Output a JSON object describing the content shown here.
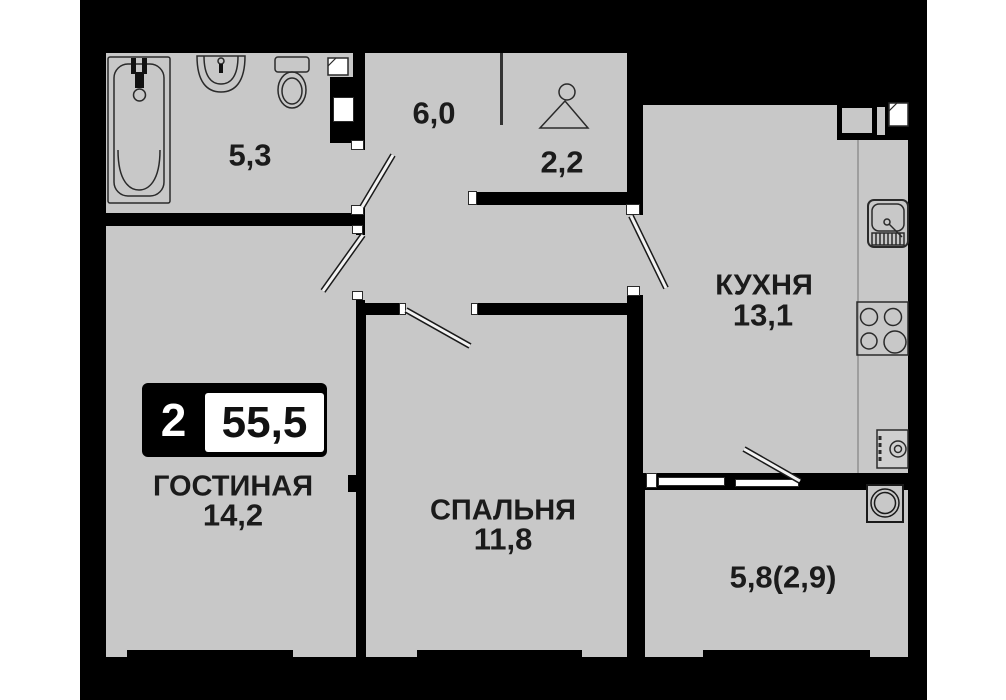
{
  "badge": {
    "rooms_count": "2",
    "total_area": "55,5"
  },
  "rooms": {
    "bathroom": {
      "area": "5,3"
    },
    "hallway": {
      "area": "6,0"
    },
    "wardrobe": {
      "area": "2,2"
    },
    "kitchen": {
      "name": "КУХНЯ",
      "area": "13,1"
    },
    "living_room": {
      "name": "ГОСТИНАЯ",
      "area": "14,2"
    },
    "bedroom": {
      "name": "СПАЛЬНЯ",
      "area": "11,8"
    },
    "balcony": {
      "area": "5,8(2,9)"
    }
  },
  "icons": {
    "bathroom": [
      "bathtub-icon",
      "sink-icon",
      "toilet-icon",
      "shelf-icon",
      "washing-machine-icon"
    ],
    "wardrobe": [
      "hanger-icon"
    ],
    "kitchen": [
      "kitchen-sink-icon",
      "stove-icon",
      "water-heater-icon",
      "shelf-icon",
      "vent-shaft"
    ],
    "balcony": [
      "washer-icon"
    ]
  },
  "colors": {
    "page_background": "#ffffff",
    "plan_background": "#000000",
    "floor": "#c8c8c8",
    "wall": "#000000",
    "fixture_stroke": "#2a2a2a",
    "text": "#1b1b1b",
    "badge_background": "#000000",
    "badge_rooms_text": "#ffffff",
    "badge_area_text": "#111111"
  }
}
